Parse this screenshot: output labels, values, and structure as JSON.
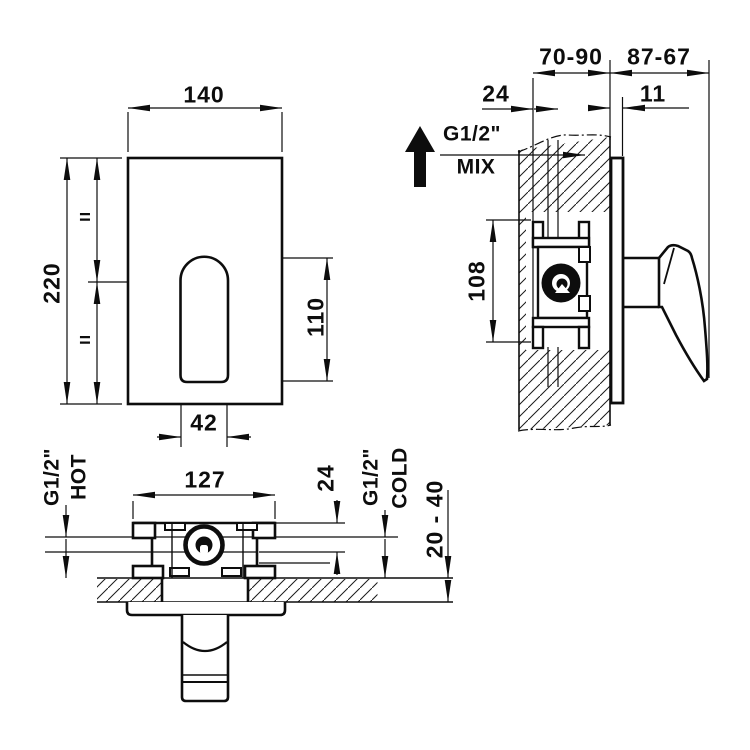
{
  "front_view": {
    "plate_width": "140",
    "plate_height": "220",
    "equal_mark_top": "=",
    "equal_mark_bottom": "=",
    "slot_height": "110",
    "slot_width": "42"
  },
  "side_view": {
    "rough_in_depth_range": "70-90",
    "protrusion_range": "87-67",
    "pipe_offset": "24",
    "plate_offset": "11",
    "mix_thread": "G1/2\"",
    "mix_label": "MIX",
    "mix_arrow_icon": "up-arrow",
    "body_height": "108"
  },
  "top_view": {
    "body_width": "127",
    "center_offset": "24",
    "hot_thread": "G1/2\"",
    "hot_label": "HOT",
    "cold_thread": "G1/2\"",
    "cold_label": "COLD",
    "wall_thickness_range": "20 - 40"
  }
}
